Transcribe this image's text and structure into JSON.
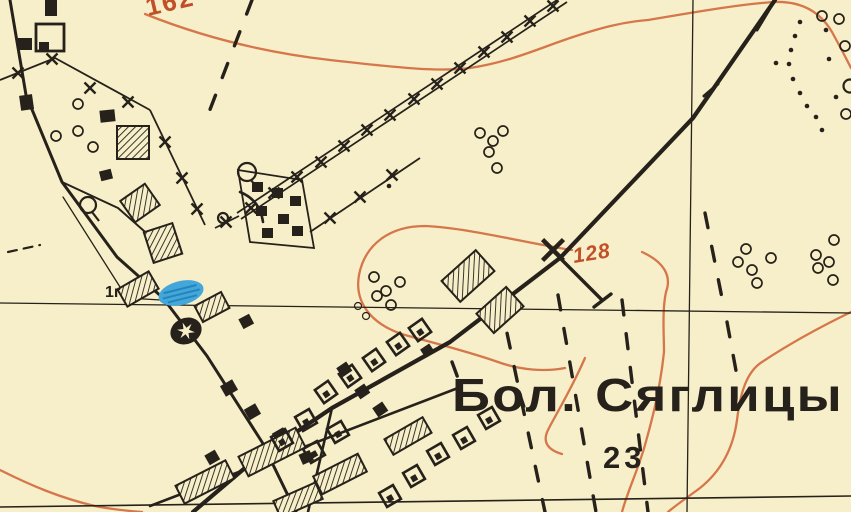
{
  "map": {
    "region_labels": {
      "village_name": "Бол.  Сяглицы",
      "household_count": "23",
      "pond_mark": "1г"
    },
    "contour_labels": {
      "top": "162",
      "middle": "128"
    },
    "colors": {
      "paper": "#f7efc9",
      "ink": "#26211a",
      "contour_line": "#d6764b",
      "contour_label": "#c14f28",
      "water_fill": "#45a7d9",
      "water_stroke": "#2286bd"
    }
  }
}
